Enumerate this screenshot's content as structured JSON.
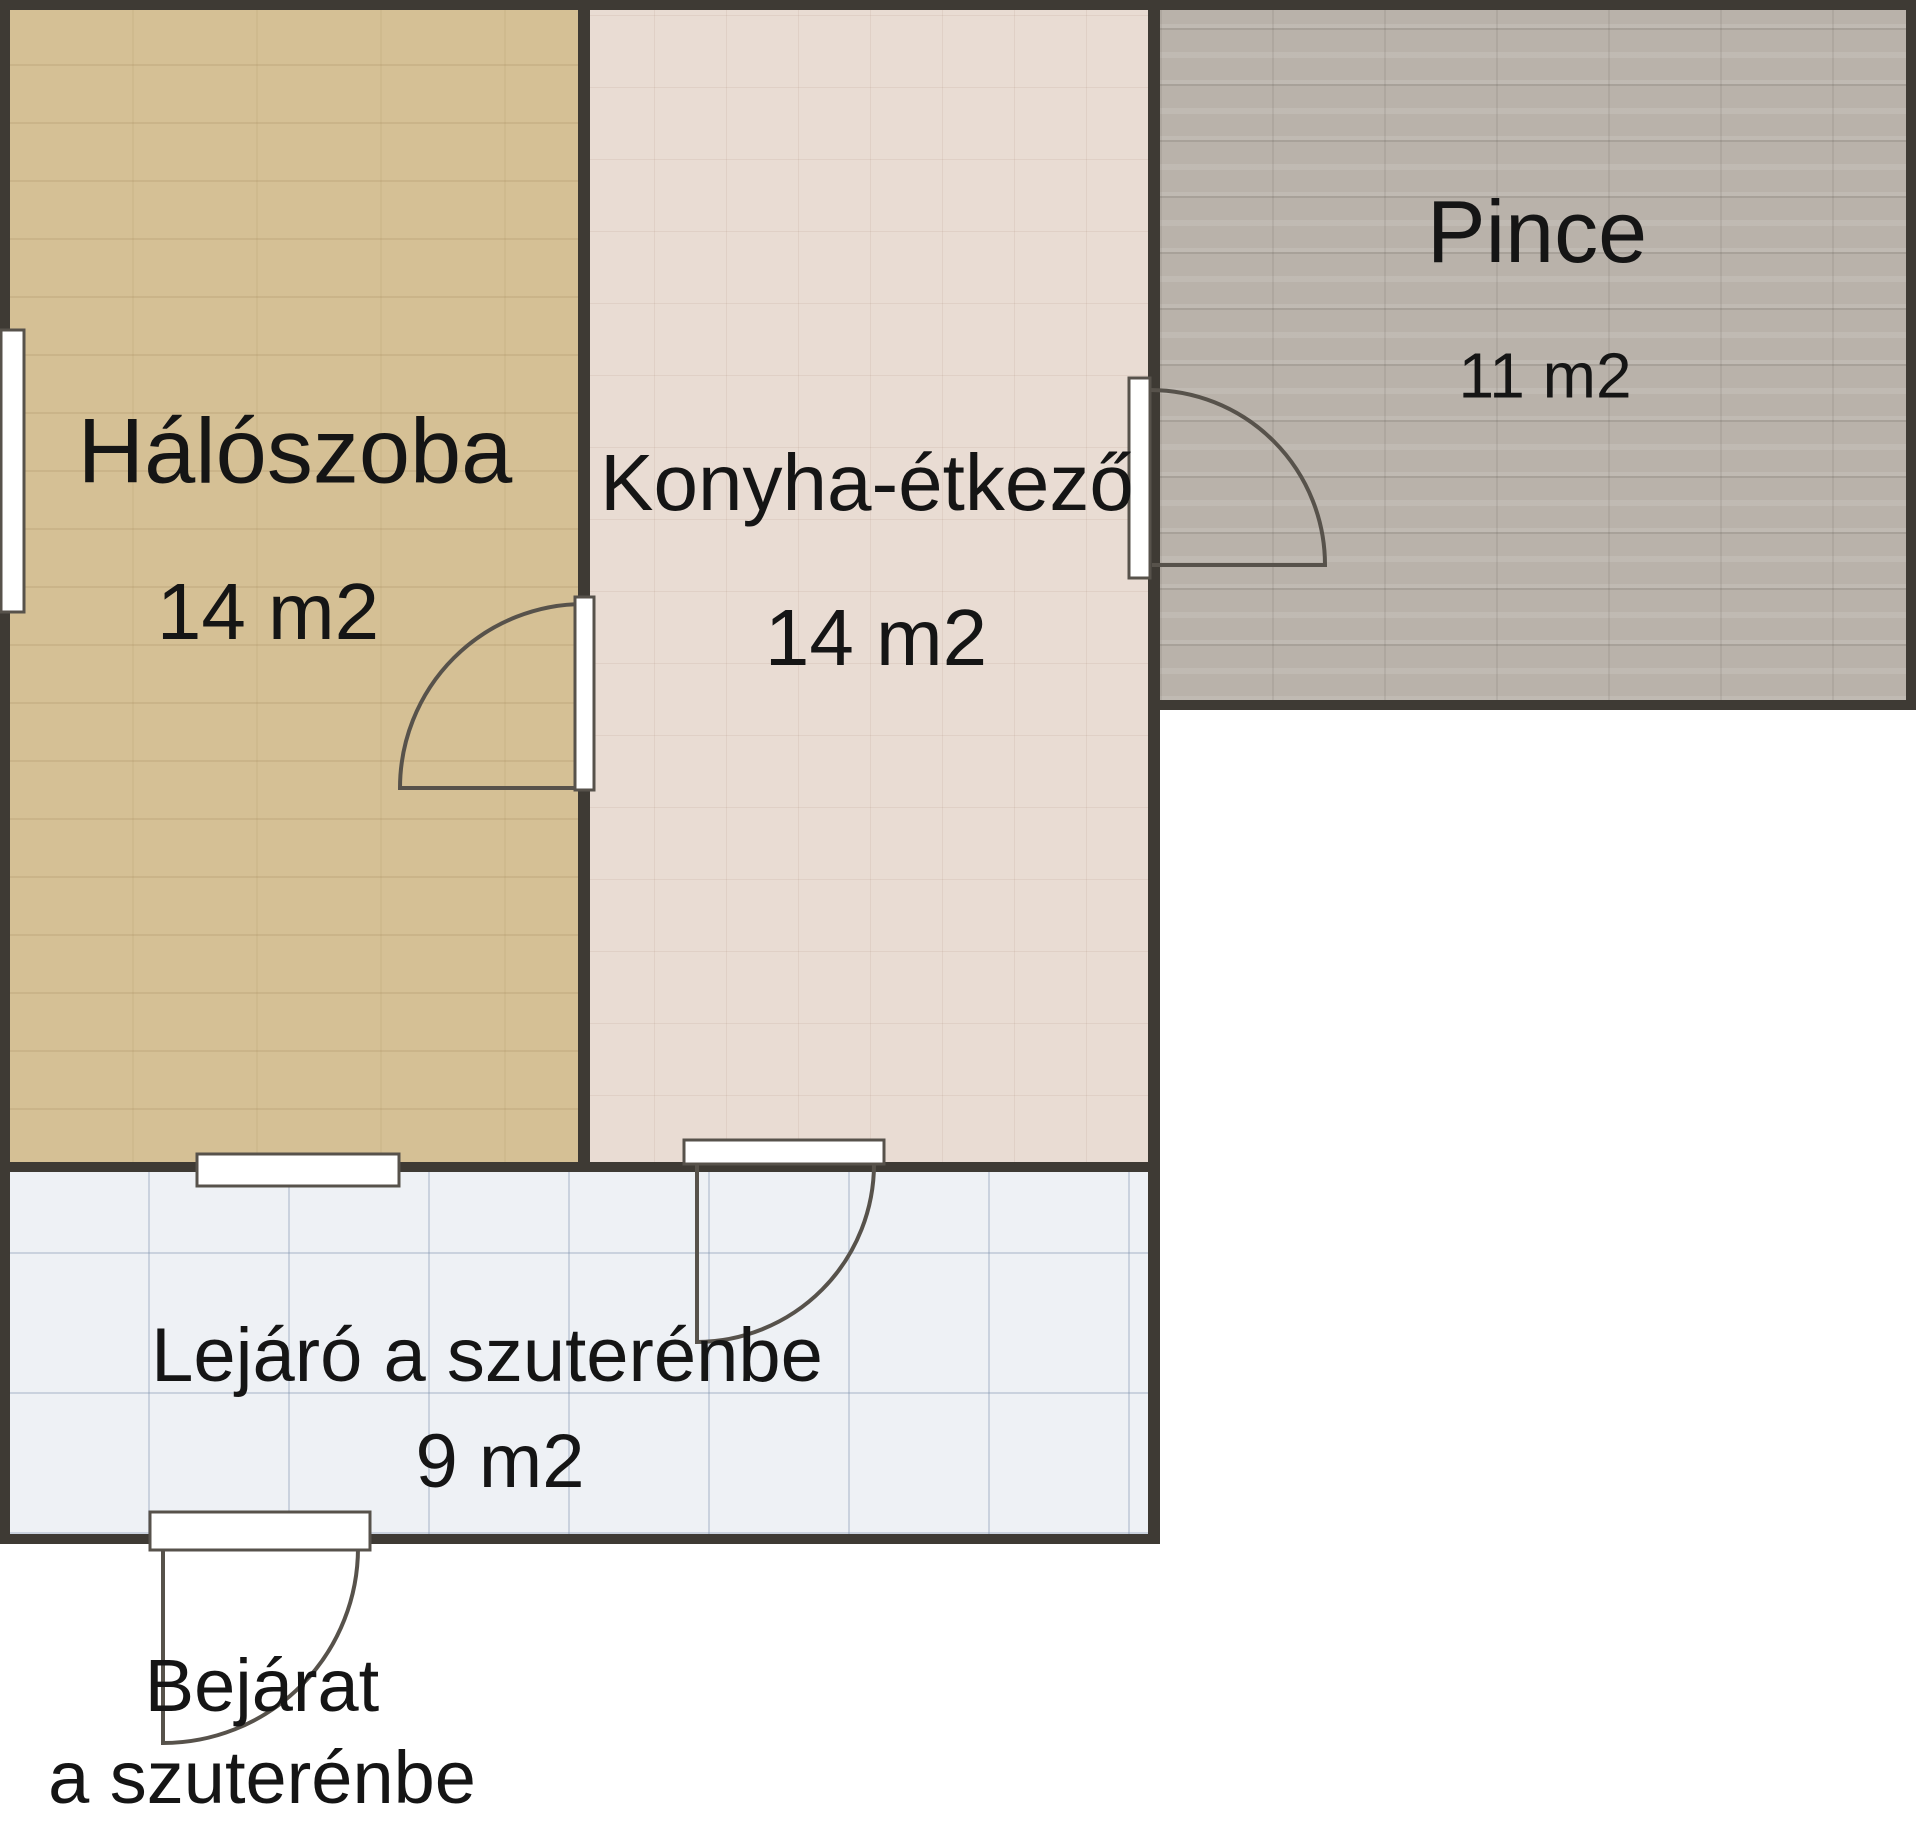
{
  "floorplan": {
    "rooms": {
      "bedroom": {
        "label": "Hálószoba",
        "area": "14 m2"
      },
      "kitchen": {
        "label": "Konyha-étkező",
        "area": "14 m2"
      },
      "cellar": {
        "label": "Pince",
        "area": "11 m2"
      },
      "stairwell": {
        "label": "Lejáró a szuterénbe",
        "area": "9 m2"
      }
    },
    "entrance_label": {
      "line1": "Bejárat",
      "line2": "a szuterénbe"
    },
    "colors": {
      "bedroom_fill": "#d5c095",
      "kitchen_fill": "#e9dcd3",
      "cellar_fill": "#b9b2aa",
      "stairwell_fill": "#eef1f5",
      "wall": "#3e3a34",
      "door_leaf": "#ffffff",
      "symbol_stroke": "#57524b",
      "text": "#151515"
    }
  }
}
